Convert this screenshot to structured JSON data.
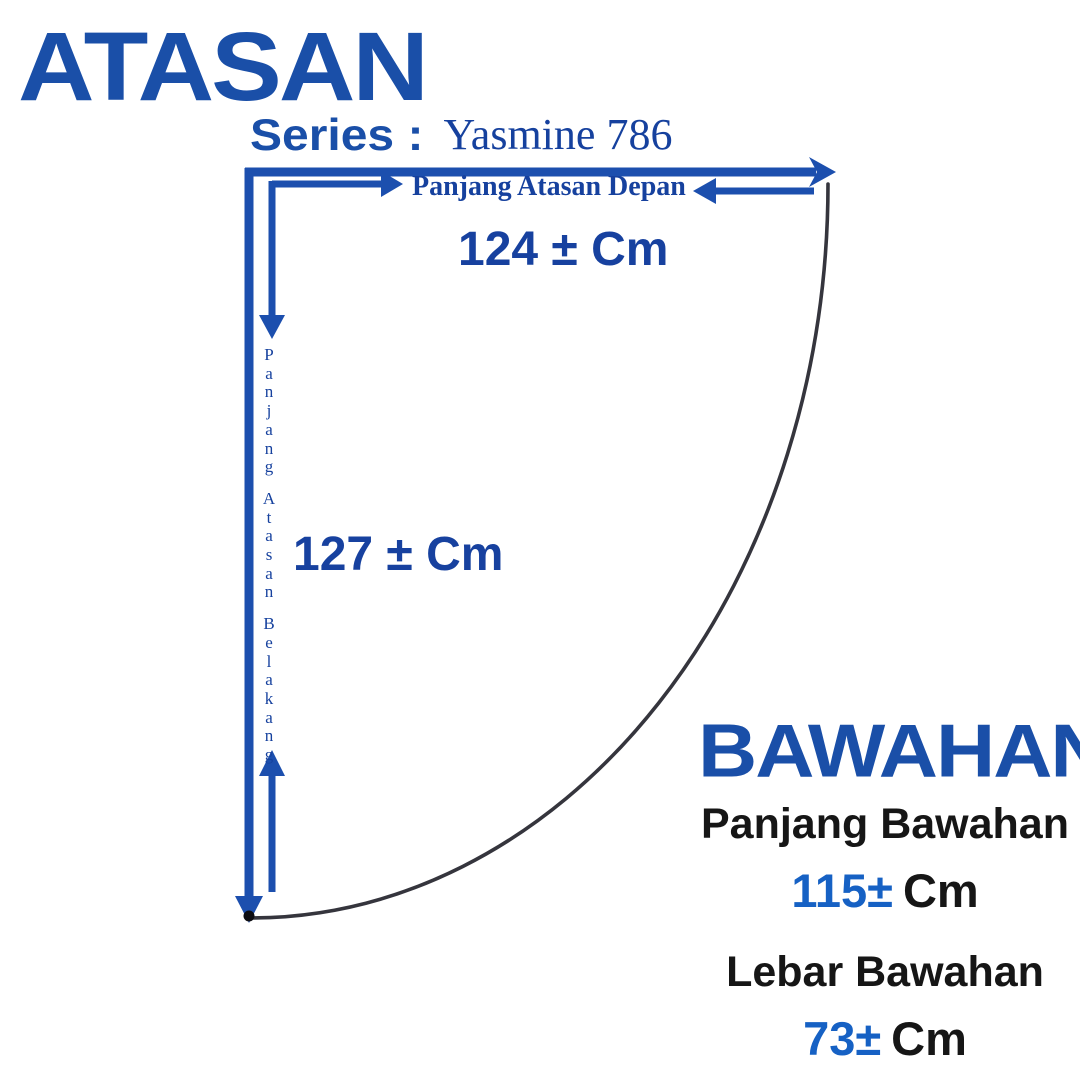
{
  "colors": {
    "brand_blue": "#1a4fa8",
    "navy_text": "#16419e",
    "num_blue": "#17419f",
    "accent_blue": "#1661c4",
    "arrow_blue": "#1c4fae",
    "curve_gray": "#35353d",
    "black_text": "#161616"
  },
  "header": {
    "title": "ATASAN",
    "series_label": "Series :",
    "series_value": "Yasmine 786"
  },
  "front_measurement": {
    "label": "Panjang Atasan Depan",
    "value": "124 ± Cm"
  },
  "back_measurement": {
    "label": "Panjang Atasan Belakang",
    "value": "127 ± Cm"
  },
  "bottom_section": {
    "title": "BAWAHAN",
    "items": [
      {
        "label": "Panjang Bawahan",
        "value": "115±",
        "unit": "Cm"
      },
      {
        "label": "Lebar Bawahan",
        "value": "73±",
        "unit": "Cm"
      }
    ]
  }
}
